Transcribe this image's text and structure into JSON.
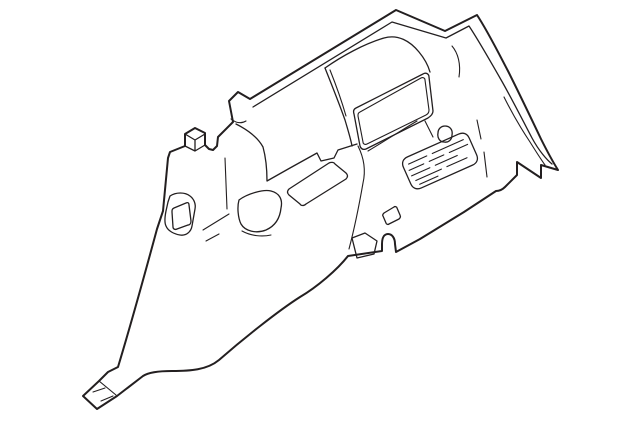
{
  "canvas": {
    "width": 640,
    "height": 423,
    "background": "#ffffff"
  },
  "drawing": {
    "alt": "Line-art illustration of an automotive interior quarter trim panel shown in perspective, with speaker vent grille, window recess, clip bosses, openings and mounting flanges",
    "stroke_color": "#231f20",
    "paths": {
      "panel_outline": "M 250,99 L 396,10 L 445,31 L 477,15 C 487,30 497,50 508,71 C 519,93 531,118 541,139 C 547,151 553,162 558,170 L 541,165 L 541,178 L 517,162 L 517,175 L 505,187 C 502,190 499,191 496,191 L 464,212 L 420,239 L 396,252 L 395,244 C 395,238 392,234 388,234 C 384,234 382,238 382,244 L 382,251 L 348,256 C 337,270 317,287 300,297 C 278,311 243,339 219,360 C 207,370 190,371 172,371 C 160,371 149,372 143,376 L 117,396 L 97,409 L 83,396 L 99,381 L 108,372 L 118,367 C 131,324 144,277 157,229 L 163,211 L 168,158 L 170,152 L 185,146 L 185,134 L 195,128 L 205,133 L 205,145 L 209,149 L 213,150 L 217,146 L 218,137 C 223,132 228,127 233,122 L 229,101 L 238,92 Z",
      "roof_inner_edge": "M 253,107 L 392,22 L 446,38 L 469,26 C 479,41 489,59 500,78 C 511,97 522,119 532,138 C 539,151 547,160 552,164",
      "pillar_inner_edge": "M 504,97 C 511,111 520,127 530,142 C 535,150 540,158 545,165",
      "pillar_top_hook": "M 452,46 C 458,53 461,64 459,77",
      "tab_inner_curve": "M 231,119 C 236,123 241,124 246,121",
      "clip_boss_edges": "M 185,134 L 195,140 L 205,134 M 195,140 L 195,151 M 185,146 L 195,151 L 205,145",
      "pillar_bulge_edge": "M 236,124 C 248,130 258,138 263,147 C 266,158 267,170 267,181 L 290,168 L 317,153 L 321,161 L 334,158 L 338,150 L 357,144",
      "pillar_crease_vertical": "M 225,158 L 227,209",
      "pillar_crease_a": "M 229,214 L 203,230",
      "pillar_crease_b": "M 219,234 L 206,241",
      "belt_opening_outer": "M 170,196 C 176,192 185,192 190,196 C 194,199 196,204 195,209 L 192,226 C 191,232 186,236 180,235 C 174,234 168,231 166,226 C 164,222 165,216 166,211 L 168,202 Z",
      "belt_opening_inner": "M 174,208 L 186,203 C 188,202 189,203 189,205 L 191,221 C 191,223 190,225 188,225 L 177,229 C 175,230 173,229 173,227 L 172,212 C 172,210 172,209 174,208 Z",
      "pocket": "M 239,200 C 247,194 263,189 271,191 C 279,193 283,199 281,208 C 280,218 275,226 266,230 C 256,234 245,231 241,224 C 238,218 237,207 239,200 Z",
      "pocket_under_curve": "M 242,231 C 251,236 262,237 271,235",
      "shelf_slot": "M 289,189 L 329,163 C 331,162 334,162 335,164 L 346,173 C 348,175 348,177 346,179 L 306,204 C 304,206 301,206 300,204 L 289,195 C 287,193 287,191 289,189 Z",
      "crease_to_flap": "M 358,146 C 364,158 366,170 363,183 C 359,206 354,230 349,249",
      "bottom_flap": "M 352,238 L 365,233 L 377,241 L 374,254 L 357,258 Z",
      "hump_top_edge": "M 325,68 C 342,56 364,44 384,38 C 398,34 410,41 419,52 C 424,58 428,65 430,72",
      "hump_left_edge": "M 325,68 C 331,83 339,103 345,120 C 348,130 351,140 352,146",
      "hump_left_inner": "M 330,70 C 336,85 342,102 346,116",
      "recess_outer": "M 356,108 L 423,74 C 426,72 429,74 429,77 L 433,111 C 433,114 431,116 428,118 L 366,149 C 363,150 361,149 360,146 L 354,114 C 353,111 354,109 356,108 Z",
      "recess_inner": "M 360,112 L 421,78 C 423,77 425,78 425,80 L 429,110 C 429,112 428,114 426,115 L 367,144 C 365,145 363,144 363,142 L 358,116 C 358,114 358,113 360,112 Z",
      "ridge_line": "M 368,151 C 388,139 402,130 417,121",
      "oval_tick": "M 425,121 L 433,137",
      "oval_hole": "M 445,126 C 450,126 453,130 452,135 C 452,140 448,143 444,142 C 440,142 437,138 438,133 C 438,129 441,126 445,126 Z",
      "grille_outline": "M 412,144 L 468,144 C 473,144 476,147 476,152 L 476,170 C 476,175 473,178 468,178 L 412,178 C 407,178 404,175 404,170 L 404,152 C 404,147 407,144 412,144 Z",
      "grille_hatch": "M 410,151 L 430,151 M 436,151 L 470,151 M 408,157 L 424,157 M 430,157 L 446,157 M 452,157 L 472,157 M 408,163 L 428,163 M 434,163 L 458,163 M 410,169 L 438,169 M 444,169 L 466,169 M 412,174 L 432,174",
      "grille_side_crease": "M 477,120 L 481,139 M 484,152 L 487,177",
      "small_slot": "M 384,213 L 394,207 C 395,206 397,207 397,208 L 400,215 C 401,217 400,218 399,219 L 389,224 C 388,225 386,224 386,223 L 383,216 C 382,215 383,214 384,213 Z",
      "foot_fold": "M 99,381 L 116,395",
      "foot_hatch": "M 93,392 L 105,388 M 101,401 L 113,396"
    },
    "grille_rotation": "rotate(-24 440 161)"
  }
}
